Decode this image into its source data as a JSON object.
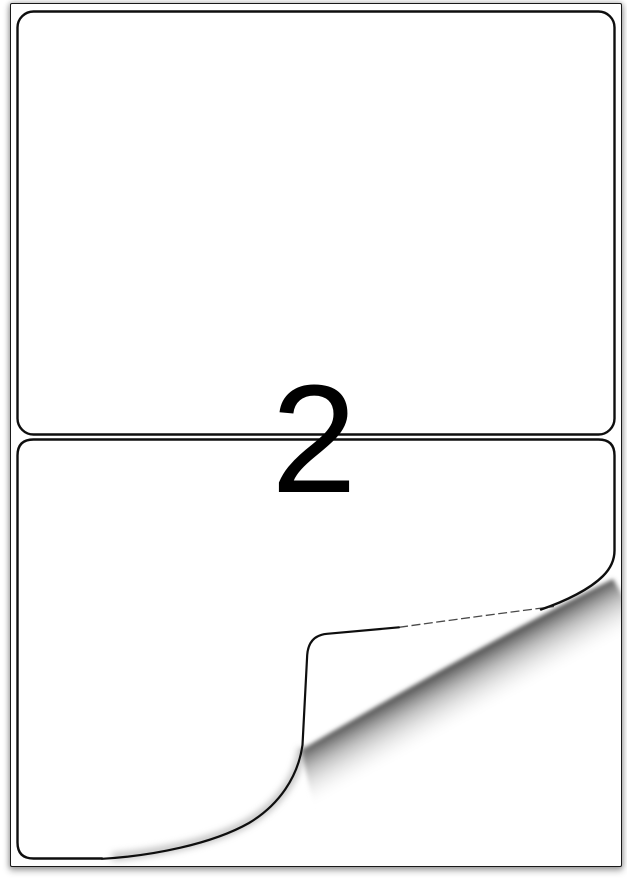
{
  "product_image": {
    "labels_per_sheet": "2",
    "colors": {
      "background": "#ffffff",
      "sheet_border": "#191919",
      "label_border": "#0e0e0e",
      "digit": "#000000",
      "curl_shadow_dark": "#4f4f4f",
      "curl_shadow_mid": "#8a8a8a",
      "curl_edge_shading": "#9c9c9c",
      "fold_faint_line": "#1c1c1c"
    }
  }
}
